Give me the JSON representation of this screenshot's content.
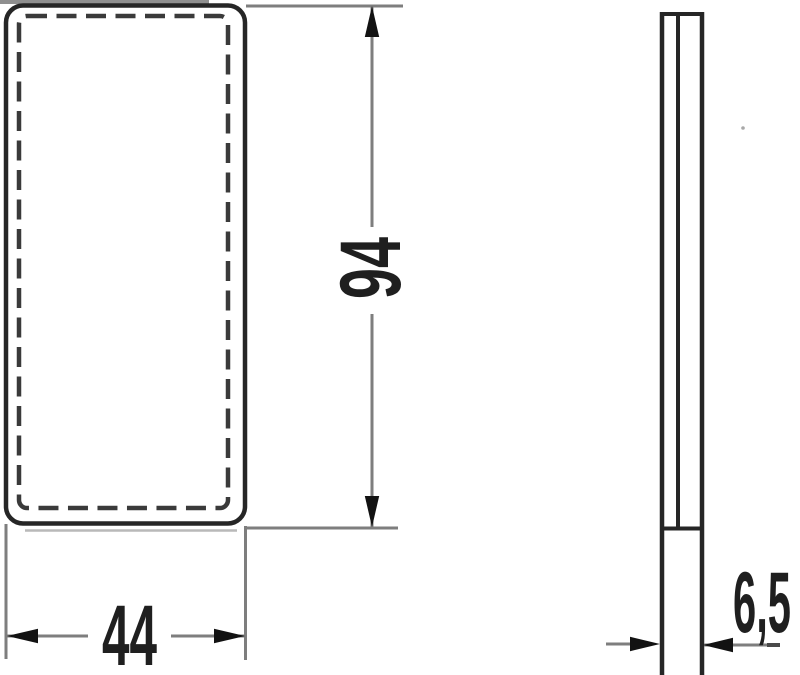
{
  "drawing": {
    "title": "reflector-dimension-drawing",
    "dimensions": {
      "height": "94",
      "width": "44",
      "depth": "6,5"
    },
    "colors": {
      "background": "#ffffff",
      "object_line": "#262626",
      "dashed_line": "#3a3a3a",
      "dimension_line": "#7e7e7e",
      "arrowhead": "#121212",
      "text": "#1f1f1f",
      "scan_artifact": "#8f8f8f"
    }
  }
}
